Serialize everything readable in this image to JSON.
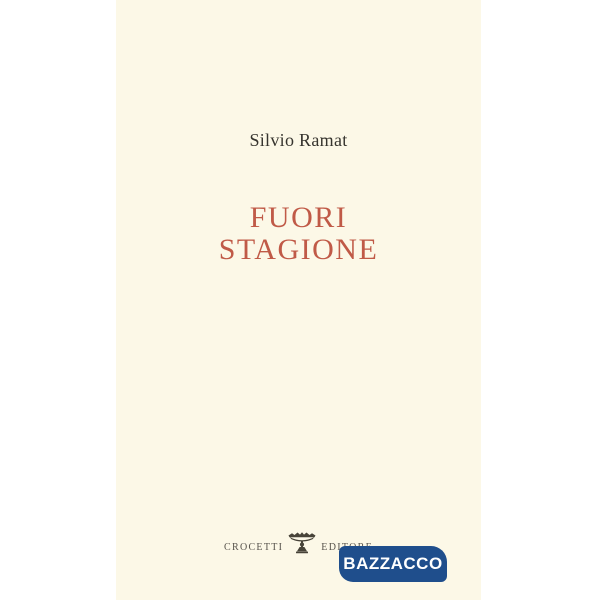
{
  "cover": {
    "author": "Silvio Ramat",
    "title": {
      "line1": "FUORI",
      "line2": "STAGIONE"
    },
    "publisher": {
      "word_left": "CROCETTI",
      "word_right": "EDITORE",
      "logo_icon": "crocetti-tazza-emblem"
    },
    "colors": {
      "paper": "#fcf8e7",
      "title_text": "#c05a47",
      "author_text": "#36342e",
      "publisher_text": "#57534c"
    }
  },
  "watermark": {
    "label": "BAZZACCO",
    "colors": {
      "background": "#1f4e8c",
      "text": "#ffffff"
    }
  },
  "page": {
    "background": "#ffffff"
  }
}
